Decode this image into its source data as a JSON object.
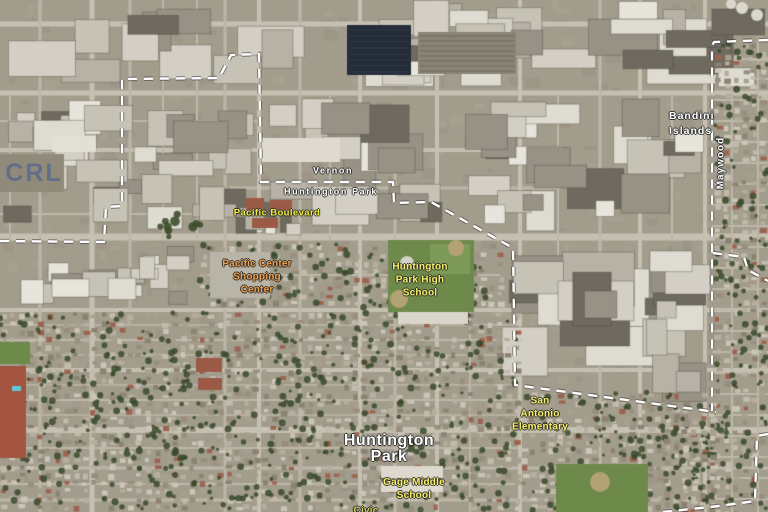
{
  "map": {
    "type": "satellite-map",
    "rooftop_text": "CRL",
    "colors": {
      "boundary_line": "#ffffff",
      "label_white": "#ffffff",
      "label_street_yellow": "#f4ef3a",
      "label_school_yellow": "#f7f267",
      "label_orange": "#f2a24c",
      "label_civic_green": "#c8d455",
      "rooftop_blue": "#5c6a8e"
    },
    "labels": {
      "vernon": {
        "text": "Vernon",
        "x": 333,
        "y": 171,
        "color": "#ffffff"
      },
      "huntington_park_boundary": {
        "text": "Huntington Park",
        "x": 331,
        "y": 192,
        "color": "#ffffff"
      },
      "pacific_boulevard": {
        "text": "Pacific Boulevard",
        "x": 277,
        "y": 213,
        "color": "#f4ef3a"
      },
      "pacific_center": {
        "lines": [
          "Pacific Center",
          "Shopping",
          "Center"
        ],
        "x": 257,
        "y": 277,
        "color": "#f2a24c"
      },
      "huntington_park_high": {
        "lines": [
          "Huntington",
          "Park High",
          "School"
        ],
        "x": 420,
        "y": 280,
        "color": "#f7f267"
      },
      "bandini_islands": {
        "lines": [
          "Bandini",
          "Islands"
        ],
        "x": 669,
        "y": 124,
        "color": "#ffffff"
      },
      "maywood": {
        "text": "Maywood",
        "x": 721,
        "y": 163,
        "color": "#ffffff"
      },
      "san_antonio": {
        "lines": [
          "San",
          "Antonio",
          "Elementary"
        ],
        "x": 540,
        "y": 414,
        "color": "#f7f267"
      },
      "huntington_park_city": {
        "lines": [
          "Huntington",
          "Park"
        ],
        "x": 389,
        "y": 449,
        "color": "#ffffff"
      },
      "gage_middle": {
        "lines": [
          "Gage Middle",
          "School"
        ],
        "x": 414,
        "y": 489,
        "color": "#f7f267"
      },
      "civic_partial": {
        "text": "Civic",
        "x": 366,
        "y": 511,
        "color": "#c8d455"
      }
    },
    "boundaries": [
      {
        "name": "huntington-park-vernon-boundary",
        "points": [
          [
            0,
            241
          ],
          [
            104,
            242
          ],
          [
            106,
            207
          ],
          [
            122,
            206
          ],
          [
            122,
            79
          ],
          [
            219,
            78
          ],
          [
            231,
            55
          ],
          [
            259,
            54
          ],
          [
            261,
            182
          ],
          [
            393,
            182
          ],
          [
            394,
            203
          ],
          [
            431,
            202
          ],
          [
            513,
            248
          ],
          [
            515,
            385
          ],
          [
            716,
            412
          ]
        ]
      },
      {
        "name": "maywood-west-boundary",
        "points": [
          [
            768,
            40
          ],
          [
            714,
            42
          ],
          [
            712,
            46
          ],
          [
            712,
            411
          ]
        ]
      },
      {
        "name": "maywood-south-branch",
        "points": [
          [
            713,
            253
          ],
          [
            744,
            257
          ],
          [
            748,
            270
          ],
          [
            768,
            281
          ]
        ]
      },
      {
        "name": "southeast-boundary",
        "points": [
          [
            768,
            434
          ],
          [
            757,
            436
          ],
          [
            755,
            501
          ],
          [
            719,
            506
          ],
          [
            663,
            512
          ]
        ]
      }
    ]
  }
}
